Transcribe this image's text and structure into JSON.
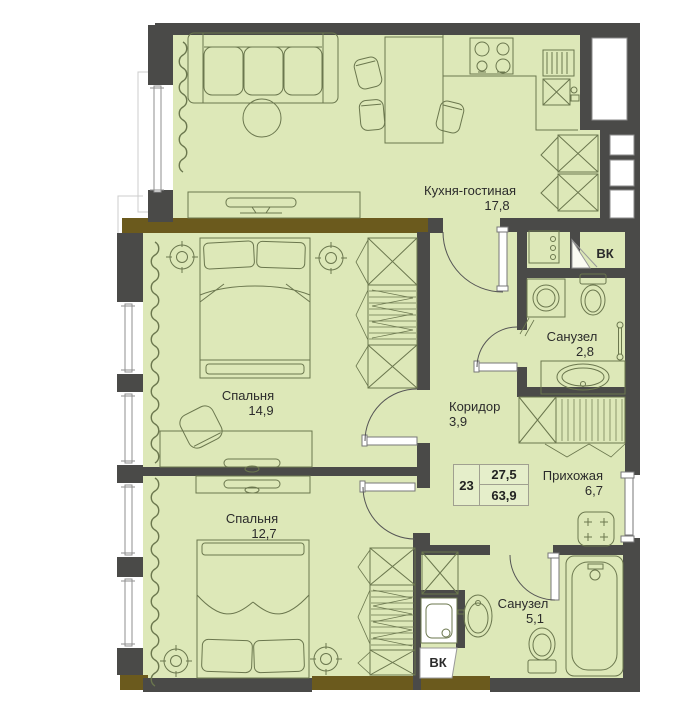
{
  "plan": {
    "rooms": {
      "kitchen_living": {
        "name": "Кухня-гостиная",
        "area": "17,8"
      },
      "bedroom_1": {
        "name": "Спальня",
        "area": "14,9"
      },
      "bedroom_2": {
        "name": "Спальня",
        "area": "12,7"
      },
      "bathroom_small": {
        "name": "Санузел",
        "area": "2,8"
      },
      "corridor": {
        "name": "Коридор",
        "area": "3,9"
      },
      "hallway": {
        "name": "Прихожая",
        "area": "6,7"
      },
      "bathroom_big": {
        "name": "Санузел",
        "area": "5,1"
      }
    },
    "shafts": {
      "vk_top": "ВК",
      "vk_bottom": "ВК"
    },
    "info_table": {
      "number": "23",
      "living_area": "27,5",
      "total_area": "63,9"
    },
    "colors": {
      "wall": "#4a4a48",
      "floor": "#dde8b8",
      "balcony_wall": "#6b5a1d",
      "furniture_line": "#6b774e"
    }
  }
}
